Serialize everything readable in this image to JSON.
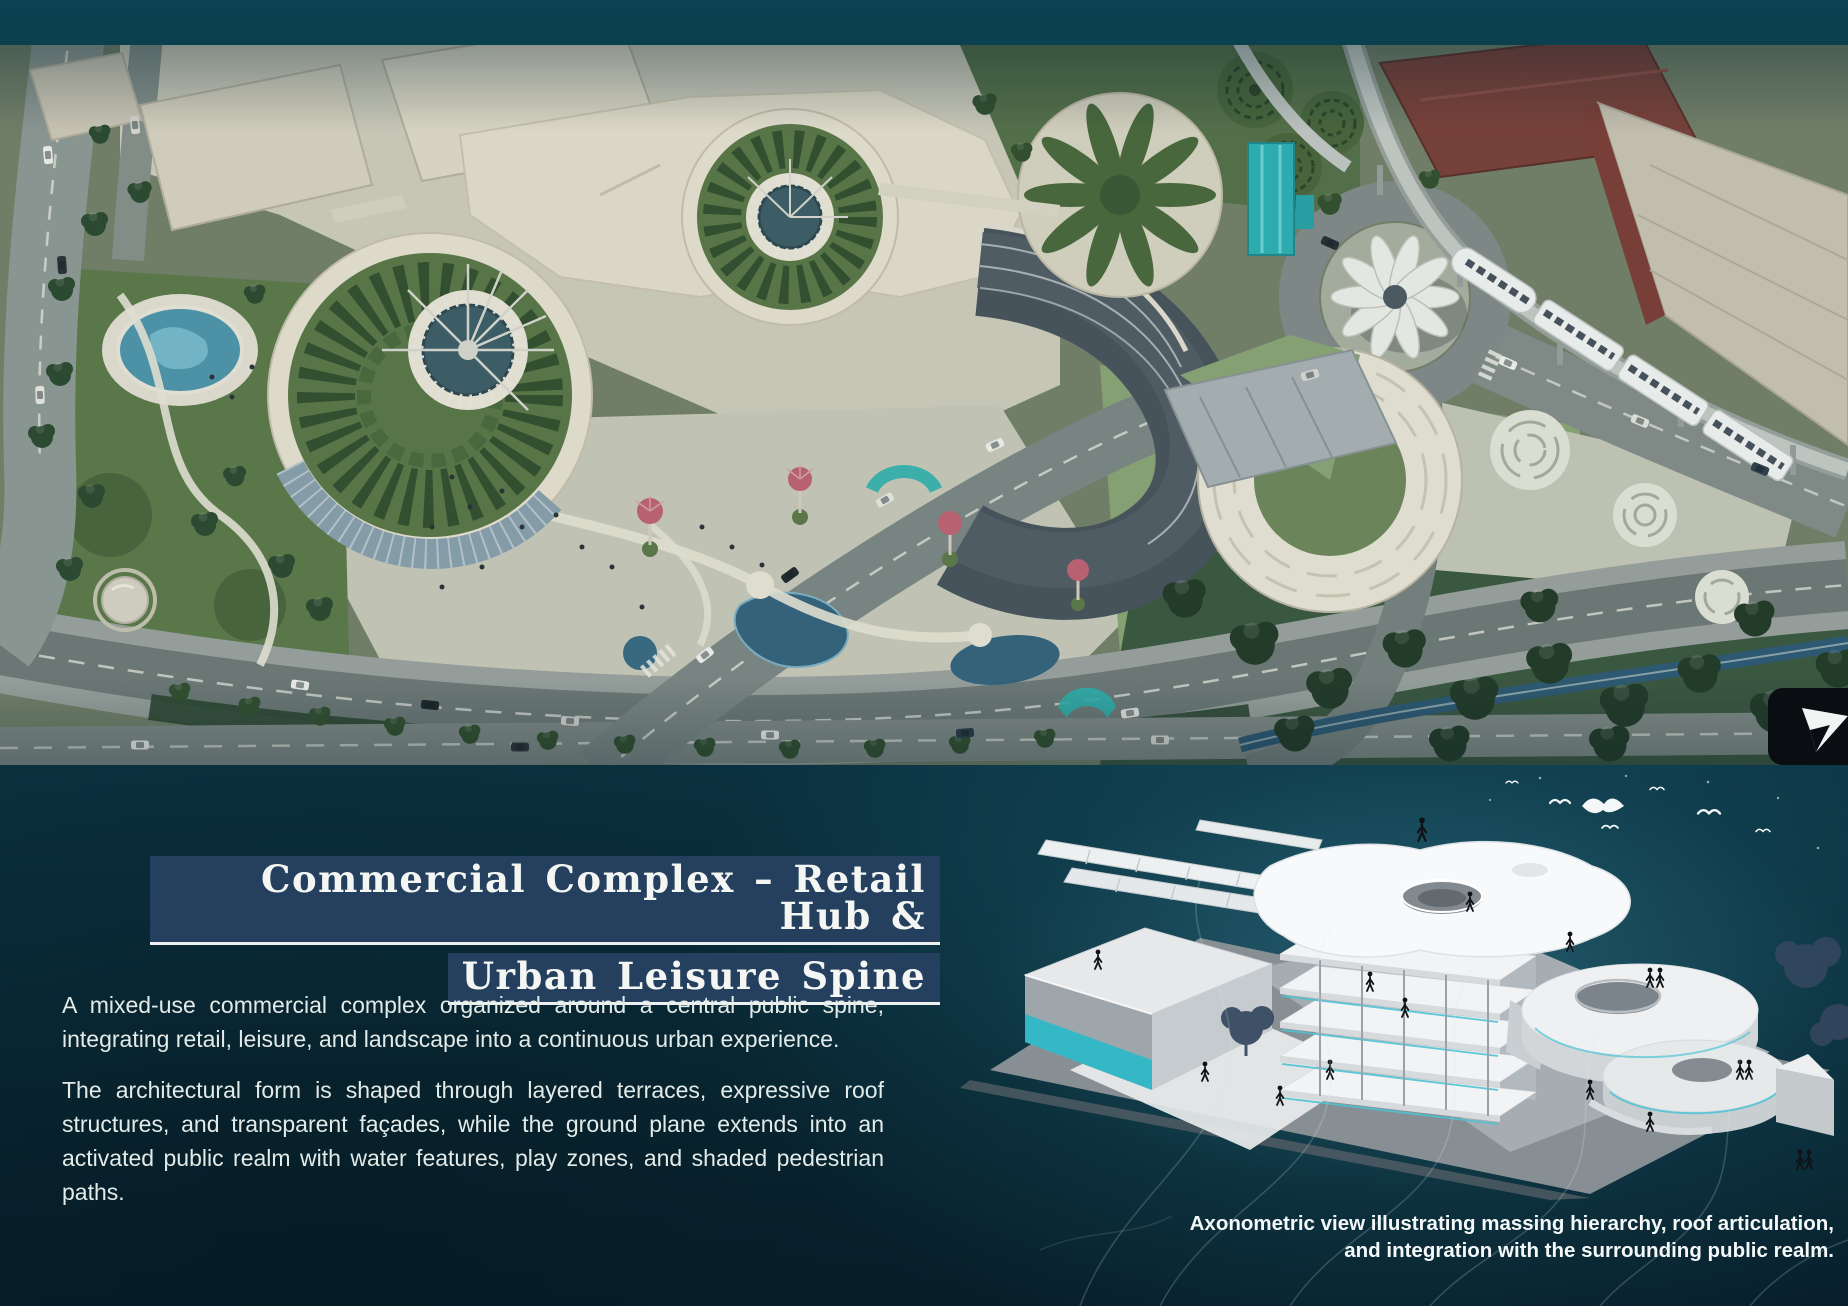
{
  "colors": {
    "background_teal": "#0b3342",
    "deep_teal": "#071f2a",
    "title_highlight": "#24405e",
    "accent_teal": "#2fb3ae",
    "text": "#e3ebe9"
  },
  "hero": {
    "alt": "Aerial render of the mixed-use commercial complex: circular green-roof drums with white supertree structures, flower-shaped pavilion on a roundabout, monorail train, crescent building, pools, gardens and surrounding roads"
  },
  "article": {
    "title_line1": "Commercial Complex – Retail Hub &",
    "title_line2": "Urban Leisure Spine",
    "paragraphs": [
      "A mixed-use commercial complex organized around a central public spine, integrating retail, leisure, and landscape into a continuous urban experience.",
      "The architectural form is shaped through layered terraces, expressive roof structures, and transparent façades, while the ground plane extends into an activated public realm with water features, play zones, and shaded pedestrian paths."
    ]
  },
  "figure": {
    "alt": "Axonometric cutaway illustration of the complex showing stacked floor plates, sculpted roof plates with circular openings, terraced round volumes, trees, birds and human silhouettes",
    "caption_line1": "Axonometric view illustrating massing hierarchy, roof articulation,",
    "caption_line2": "and integration with the surrounding public realm."
  }
}
